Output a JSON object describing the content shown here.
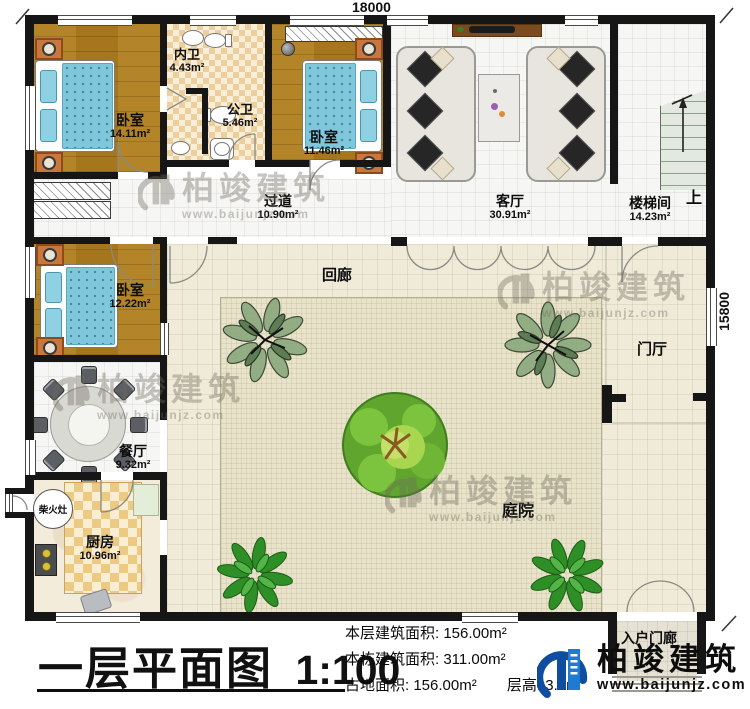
{
  "dimensions": {
    "top": "18000",
    "right": "15800"
  },
  "rooms": {
    "bedroom_a": {
      "name": "卧室",
      "area": "14.11m²"
    },
    "ensuite_bath": {
      "name": "内卫",
      "area": "4.43m²"
    },
    "shared_bath": {
      "name": "公卫",
      "area": "5.46m²"
    },
    "bedroom_b": {
      "name": "卧室",
      "area": "11.46m²"
    },
    "corridor": {
      "name": "过道",
      "area": "10.90m²"
    },
    "living_room": {
      "name": "客厅",
      "area": "30.91m²"
    },
    "stair_hall": {
      "name": "楼梯间",
      "area": "14.23m²"
    },
    "stair_up_label": "上",
    "bedroom_c": {
      "name": "卧室",
      "area": "12.22m²"
    },
    "cloister": {
      "name": "回廊"
    },
    "dining_room": {
      "name": "餐厅",
      "area": "9.32m²"
    },
    "firewood_stove": {
      "name": "柴火灶"
    },
    "kitchen": {
      "name": "厨房",
      "area": "10.96m²"
    },
    "courtyard": {
      "name": "庭院"
    },
    "foyer": {
      "name": "门厅"
    },
    "entry_porch": {
      "name": "入户门廊"
    }
  },
  "title_block": {
    "title": "一层平面图",
    "scale": "1:100"
  },
  "stats": {
    "line1_label": "本层建筑面积:",
    "line1_value": "156.00m²",
    "line2_label": "本栋建筑面积:",
    "line2_value": "311.00m²",
    "line3_label": "占地面积:",
    "line3_value": "156.00m²",
    "line4_label": "层高:",
    "line4_value": "3.0m"
  },
  "branding": {
    "company": "柏竣建筑",
    "website": "www.baijunjz.com"
  },
  "watermark": {
    "company": "柏竣建筑",
    "website": "www.baijunjz.com"
  },
  "colors": {
    "wall": "#161616",
    "wood_floor": "#ac7b20",
    "bed": "#80c7db",
    "bath_tile": "#eccf9c",
    "kitchen_tile": "#ecca84",
    "courtyard_floor": "#e8e3c9",
    "cloister_floor": "#efebd8",
    "stair_tread": "#e3e9e1",
    "logo_blue_dark": "#0f4e9e",
    "logo_blue_light": "#1e7ad2"
  }
}
